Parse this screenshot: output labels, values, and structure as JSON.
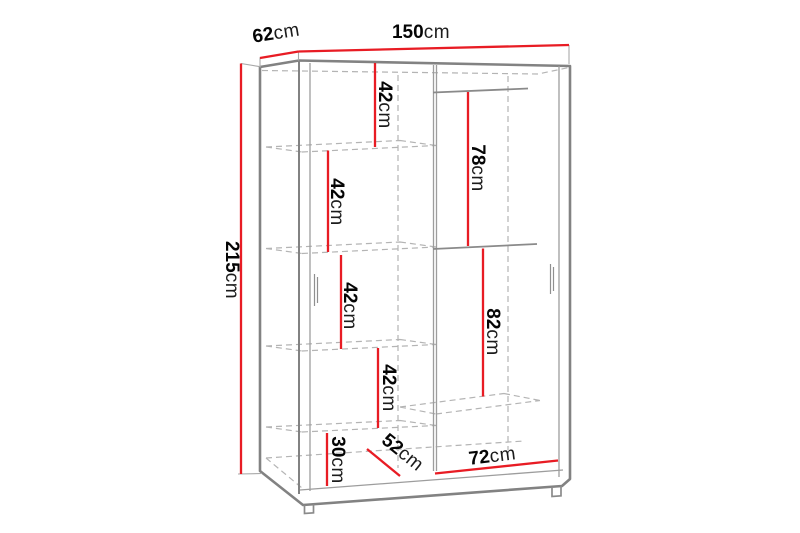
{
  "diagram": {
    "type": "furniture-dimension-drawing",
    "subject": "two-door sliding wardrobe with shelves and hanging rails",
    "colors": {
      "dimension_line": "#e81c24",
      "outline": "#828282",
      "thin_line": "#9d9d9d",
      "hidden_line": "#b4b4b4",
      "label_text": "#050505",
      "background": "#ffffff"
    },
    "overall": {
      "width": {
        "value": "150",
        "unit": "cm"
      },
      "depth": {
        "value": "62",
        "unit": "cm"
      },
      "height": {
        "value": "215",
        "unit": "cm"
      }
    },
    "interior": {
      "shelf_gap_top": {
        "value": "42",
        "unit": "cm"
      },
      "shelf_gap_upper": {
        "value": "42",
        "unit": "cm"
      },
      "shelf_gap_middle": {
        "value": "42",
        "unit": "cm"
      },
      "shelf_gap_lower": {
        "value": "42",
        "unit": "cm"
      },
      "bottom_gap": {
        "value": "30",
        "unit": "cm"
      },
      "hanging_upper": {
        "value": "78",
        "unit": "cm"
      },
      "hanging_lower": {
        "value": "82",
        "unit": "cm"
      },
      "floor_depth": {
        "value": "52",
        "unit": "cm"
      },
      "floor_width": {
        "value": "72",
        "unit": "cm"
      }
    }
  }
}
